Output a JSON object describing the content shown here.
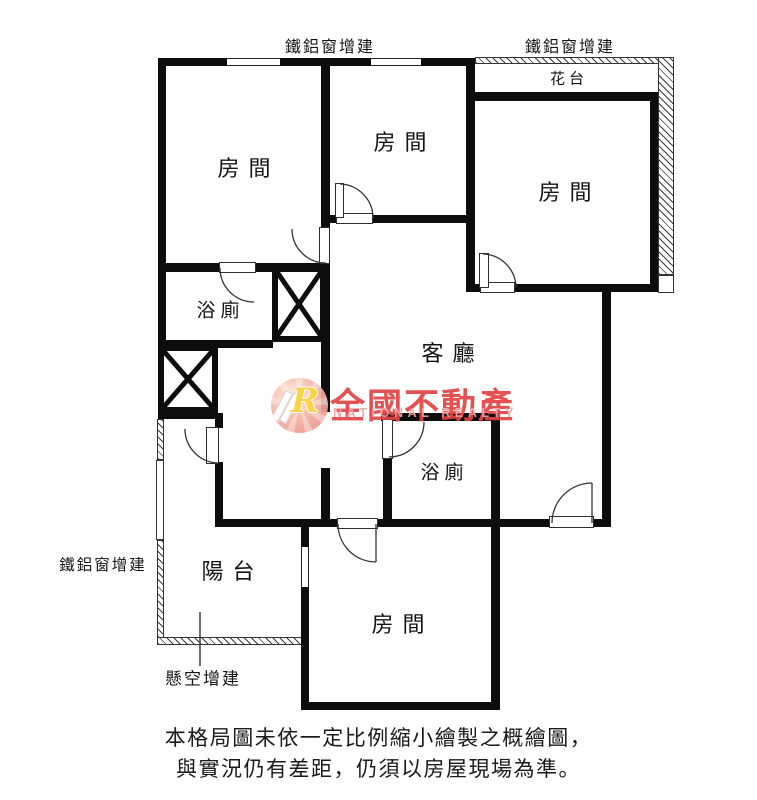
{
  "floor_plan": {
    "labels": {
      "addition_top_left": "鐵鋁窗增建",
      "addition_top_right": "鐵鋁窗增建",
      "addition_left": "鐵鋁窗增建",
      "flower_bed": "花台",
      "room_top_left": "房間",
      "room_top_middle": "房間",
      "room_top_right": "房間",
      "room_bottom": "房間",
      "bathroom_upper": "浴廁",
      "bathroom_lower": "浴廁",
      "living_room": "客廳",
      "balcony": "陽台",
      "suspended_addition": "懸空增建"
    },
    "watermark": {
      "logo_letter": "R",
      "brand_name": "全國不動產",
      "brand_name_en": "NATIONAL REALTY",
      "brand_color": "#e34444",
      "brand_color_light": "#f0a3a3",
      "logo_letter_color": "#f8cf3b"
    },
    "disclaimer": {
      "line1": "本格局圖未依一定比例縮小繪製之概繪圖，",
      "line2": "與實況仍有差距，仍須以房屋現場為準。"
    },
    "colors": {
      "wall": "#0d0d0d",
      "line": "#333333",
      "background": "#ffffff"
    }
  }
}
